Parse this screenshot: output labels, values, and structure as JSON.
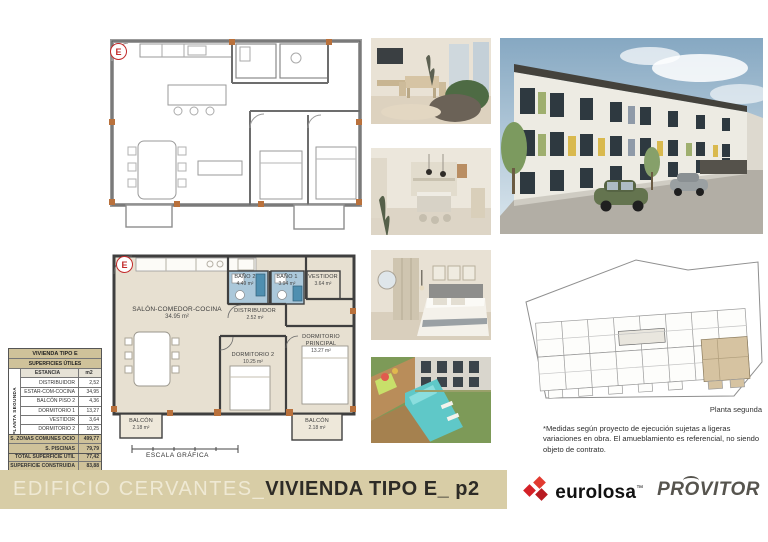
{
  "plans": {
    "upper": {
      "marker": "E"
    },
    "lower": {
      "marker": "E",
      "salon": {
        "name": "SALÓN-COMEDOR-COCINA",
        "area": "34.95 m²"
      },
      "bano2": {
        "name": "BAÑO 2",
        "area": "4.49 m²"
      },
      "bano1": {
        "name": "BAÑO 1",
        "area": "3.94 m²"
      },
      "vestidor": {
        "name": "VESTIDOR",
        "area": "3.64 m²"
      },
      "distribuidor": {
        "name": "DISTRIBUIDOR",
        "area": "2.52 m²"
      },
      "dormitorio_principal": {
        "name": "DORMITORIO PRINCIPAL",
        "area": "13.27 m²"
      },
      "dormitorio2": {
        "name": "DORMITORIO 2",
        "area": "10.25 m²"
      },
      "balcon_left": {
        "name": "BALCÓN",
        "area": "2.18 m²"
      },
      "balcon_right": {
        "name": "BALCÓN",
        "area": "2.18 m²"
      },
      "scale_label": "ESCALA GRÁFICA"
    }
  },
  "surface_table": {
    "title": "VIVIENDA TIPO E",
    "subtitle": "SUPERFICIES ÚTILES",
    "side_label": "PLANTA SEGUNDA",
    "header": {
      "estancia": "ESTANCIA",
      "m2": "m2"
    },
    "rows": [
      {
        "label": "DISTRIBUIDOR",
        "value": "2,52"
      },
      {
        "label": "ESTAR-COM-COCINA",
        "value": "34,95"
      },
      {
        "label": "BALCÓN PISO 2",
        "value": "4,36"
      },
      {
        "label": "DORMITORIO 1",
        "value": "13,27"
      },
      {
        "label": "VESTIDOR",
        "value": "3,64"
      },
      {
        "label": "DORMITORIO 2",
        "value": "10,25"
      },
      {
        "label": "BAÑO 1",
        "value": "3,94"
      },
      {
        "label": "BAÑO 2",
        "value": "4,49"
      }
    ],
    "totals": [
      {
        "label": "TOTAL SUPERFICIE ÚTIL",
        "value": "77,42"
      },
      {
        "label": "SUPERFICIE CONSTRUIDA",
        "value": "83,88"
      }
    ],
    "extras": [
      {
        "label": "S. ZONAS COMUNES OCIO",
        "value": "499,77"
      },
      {
        "label": "S. PISCINAS",
        "value": "79,79"
      }
    ]
  },
  "site_plan": {
    "caption": "Planta segunda"
  },
  "disclaimer": "*Medidas según proyecto de ejecución sujetas a ligeras variaciones en obra. El amueblamiento es referencial, no siendo objeto de contrato.",
  "footer": {
    "project": "EDIFICIO CERVANTES_",
    "unit": "VIVIENDA TIPO E_ p2",
    "brand1": "eurolosa",
    "brand1_mark": "™",
    "brand2_pre": "PR",
    "brand2_o": "O",
    "brand2_post": "VITOR"
  },
  "colors": {
    "footer_band": "#d8cda6",
    "room_fill": "#e7e0d1",
    "bath_fill": "#abc8da",
    "column_marker": "#b9713c",
    "brand_red": "#d42027",
    "pool": "#5fc8c8"
  }
}
